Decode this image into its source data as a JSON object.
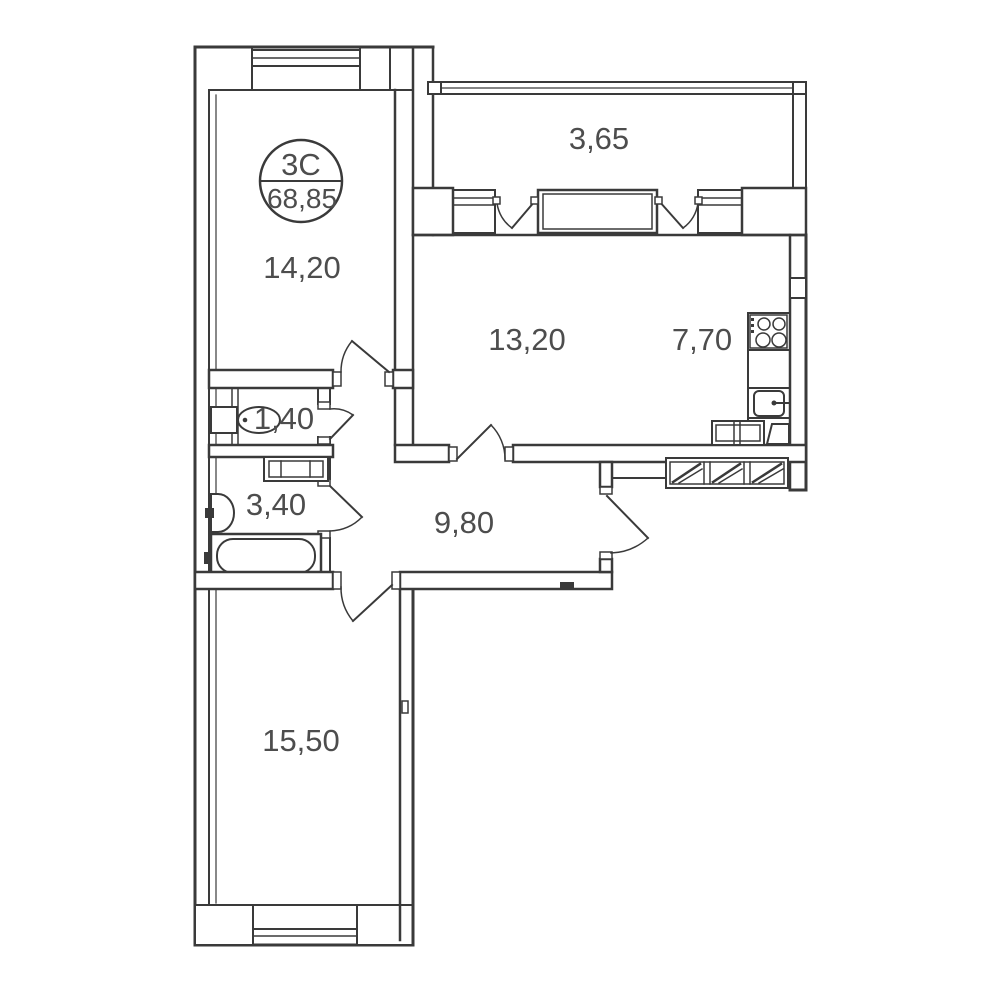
{
  "badge": {
    "type_label": "3C",
    "area_label": "68,85"
  },
  "rooms": {
    "balcony": {
      "label": "balcony",
      "area": "3,65"
    },
    "bedroom1": {
      "label": "bedroom-1",
      "area": "14,20"
    },
    "living": {
      "label": "living-room",
      "area": "13,20"
    },
    "kitchen": {
      "label": "kitchen",
      "area": "7,70"
    },
    "wc": {
      "label": "wc",
      "area": "1,40"
    },
    "bathroom": {
      "label": "bathroom",
      "area": "3,40"
    },
    "hallway": {
      "label": "hallway",
      "area": "9,80"
    },
    "bedroom2": {
      "label": "bedroom-2",
      "area": "15,50"
    }
  },
  "colors": {
    "wall": "#3a3a3a",
    "label": "#4d4d4d",
    "background": "#ffffff"
  }
}
